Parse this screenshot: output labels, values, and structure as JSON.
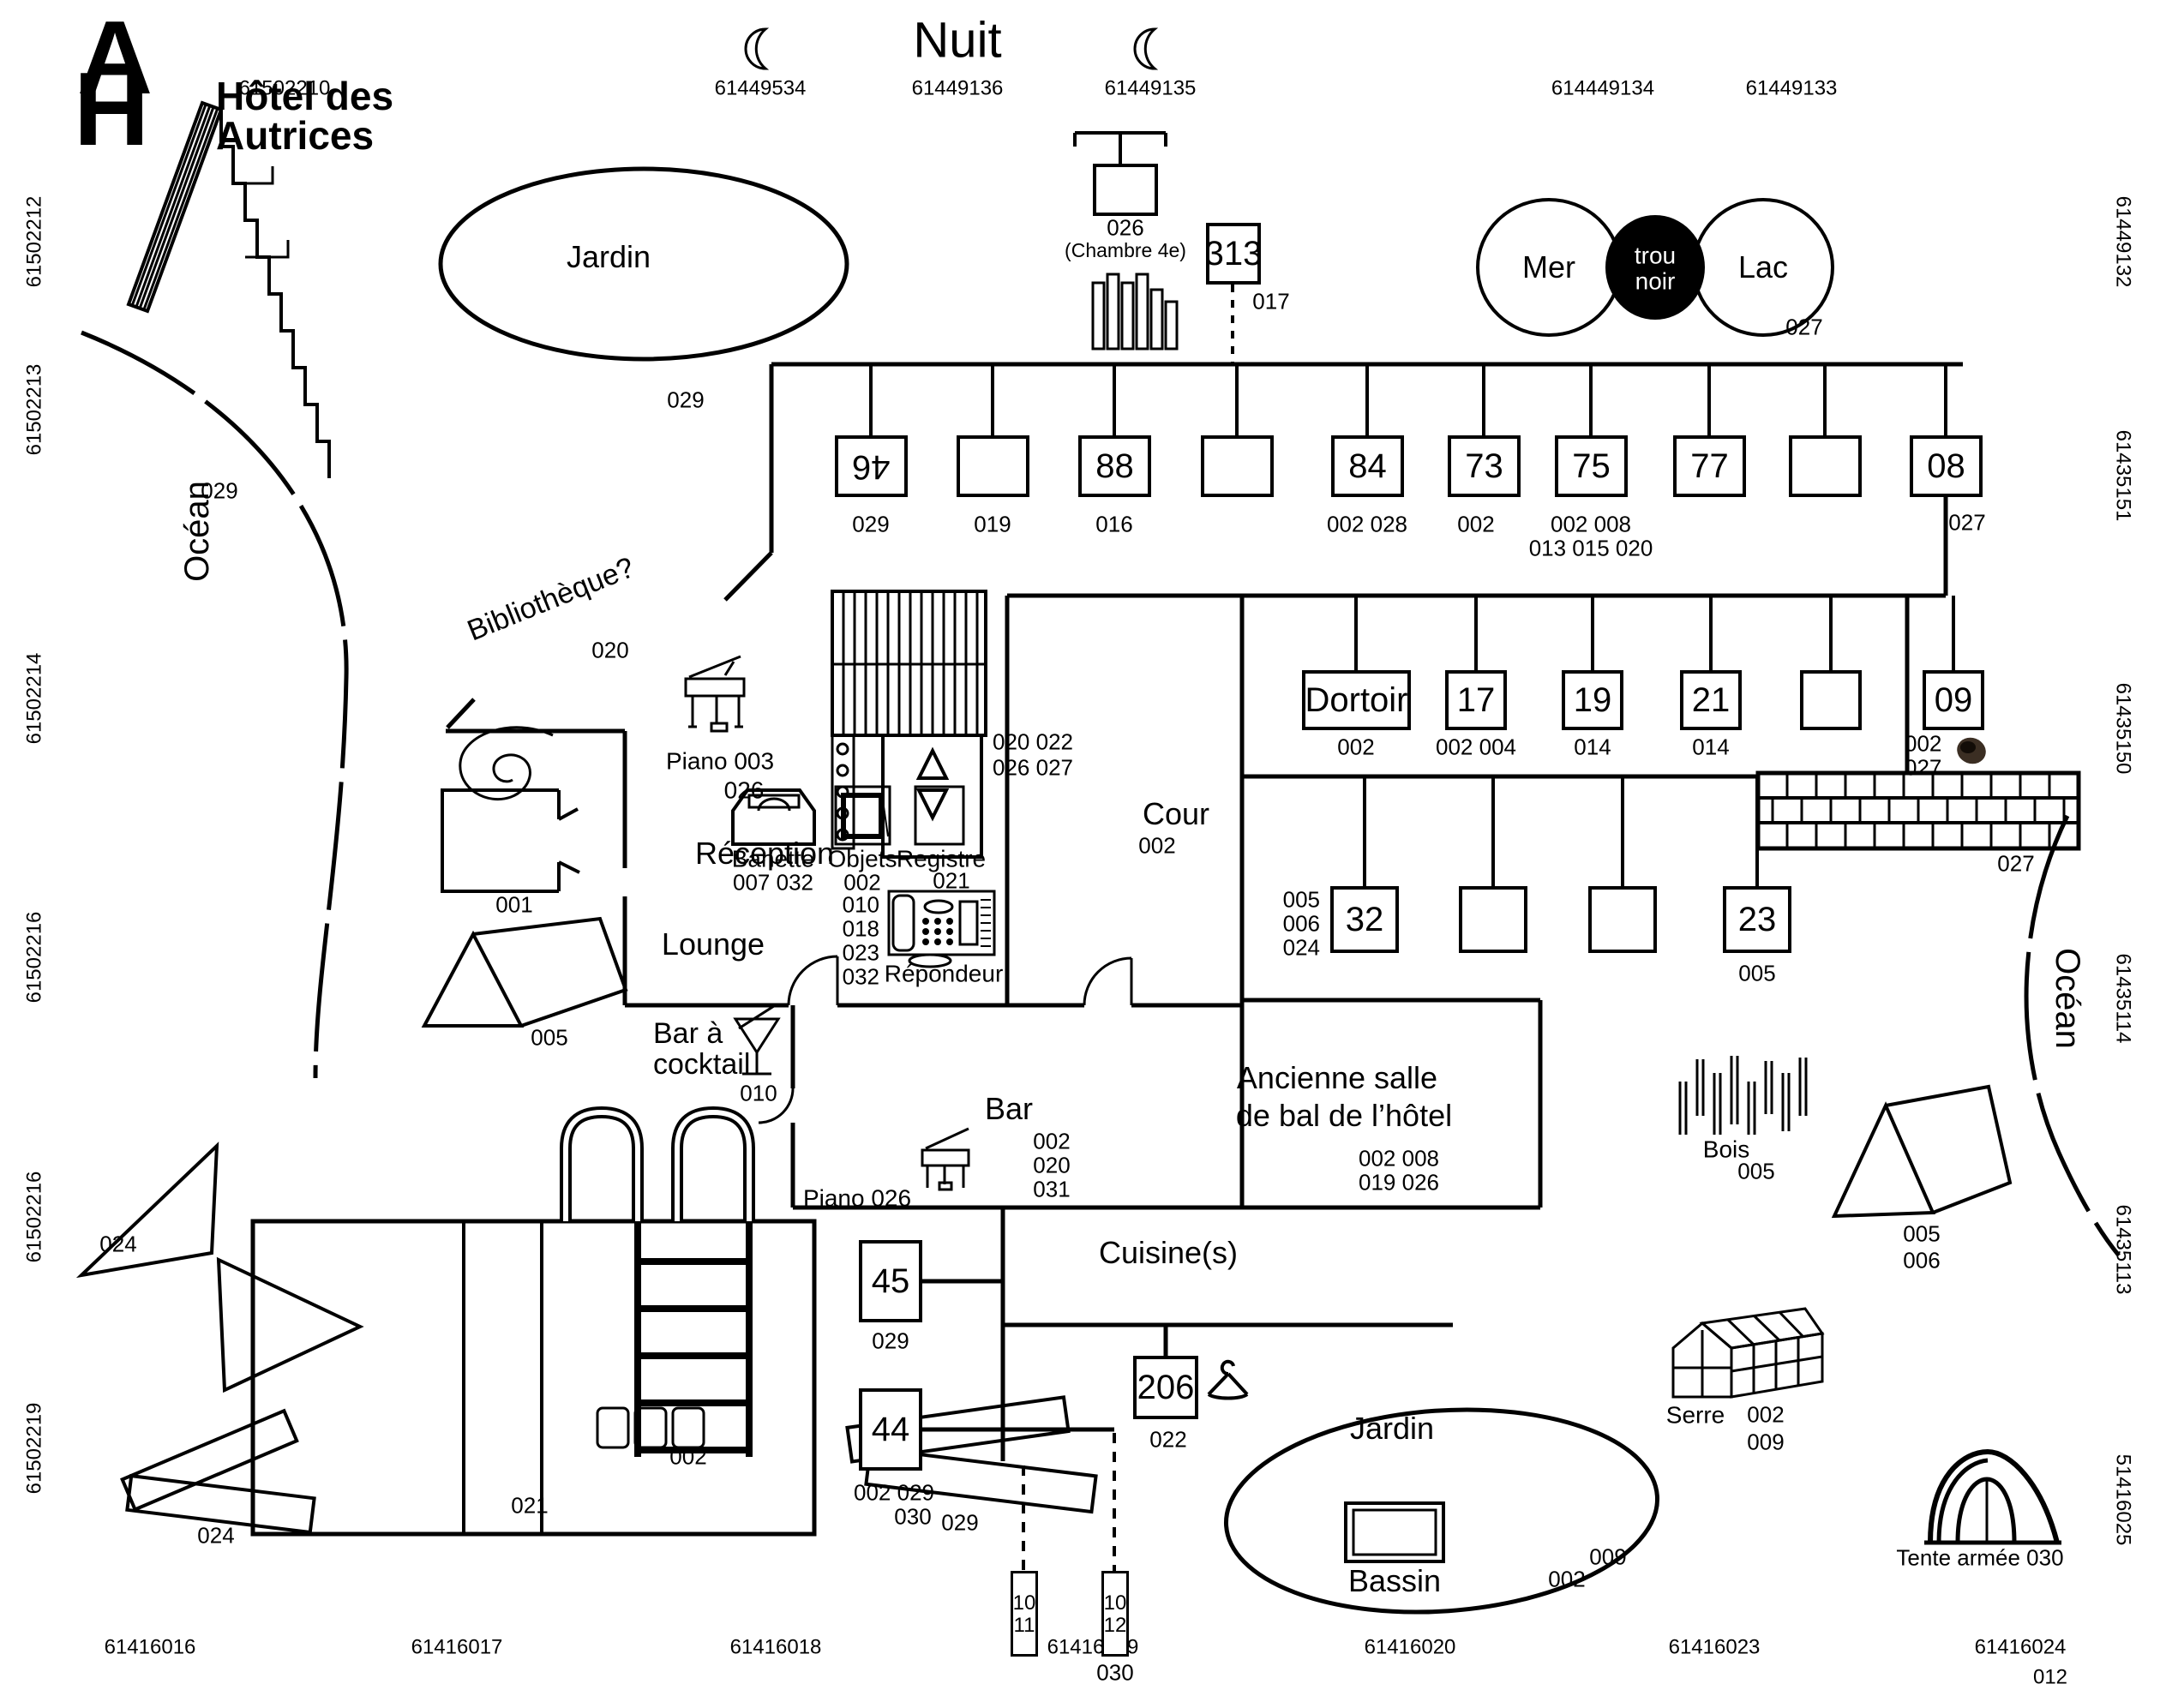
{
  "meta": {
    "logo_a": "A",
    "logo_h": "H",
    "title_line1": "Hôtel des",
    "title_line2": "Autrices",
    "heading": "Nuit",
    "ink_color": "#000000",
    "paper_color": "#ffffff",
    "smudge_color": "#2a1c10"
  },
  "edge_labels": {
    "top": [
      "61502210",
      "61449534",
      "61449136",
      "61449135",
      "614449134",
      "61449133"
    ],
    "left": [
      "61502212",
      "61502213",
      "61502214",
      "61502216",
      "61502216",
      "61502219"
    ],
    "right": [
      "61449132",
      "61435151",
      "61435150",
      "61435114",
      "61435113",
      "51416025"
    ],
    "bottom": [
      "61416016",
      "61416017",
      "61416018",
      "61416019",
      "61416020",
      "61416023",
      "61416024"
    ],
    "bottom_extra": "012"
  },
  "top_features": {
    "chambre4e": {
      "num": "026",
      "sub": "(Chambre 4e)"
    },
    "box313": {
      "num": "313",
      "note": "017"
    }
  },
  "row1": [
    {
      "num": "46",
      "note": "029"
    },
    {
      "num": "",
      "note": "019"
    },
    {
      "num": "88",
      "note": "016"
    },
    {
      "num": "",
      "note": ""
    },
    {
      "num": "84",
      "note": "002 028"
    },
    {
      "num": "73",
      "note": "002"
    },
    {
      "num": "75",
      "note": "002 008",
      "note2": "013 015 020"
    },
    {
      "num": "77",
      "note": ""
    },
    {
      "num": "",
      "note": ""
    },
    {
      "num": "08",
      "note": "027"
    }
  ],
  "row2": [
    {
      "num": "Dortoir",
      "note": "002"
    },
    {
      "num": "17",
      "note": "002 004"
    },
    {
      "num": "19",
      "note": "014"
    },
    {
      "num": "21",
      "note": "014"
    },
    {
      "num": "",
      "note": ""
    },
    {
      "num": "09",
      "note": "002",
      "note2": "027"
    }
  ],
  "row3": {
    "side_notes": [
      "005",
      "006",
      "024"
    ],
    "boxes": [
      {
        "num": "32",
        "note": ""
      },
      {
        "num": "",
        "note": ""
      },
      {
        "num": "",
        "note": ""
      },
      {
        "num": "23",
        "note": "005"
      }
    ]
  },
  "areas": {
    "jardin_top": {
      "label": "Jardin",
      "note": "029"
    },
    "mer": {
      "label": "Mer"
    },
    "trou_noir": {
      "line1": "trou",
      "line2": "noir"
    },
    "lac": {
      "label": "Lac",
      "note": "027"
    },
    "bibliotheque": {
      "label": "Bibliothèque?",
      "note": "020"
    },
    "reception": {
      "label": "Réception"
    },
    "lounge": {
      "label": "Lounge"
    },
    "cour": {
      "label": "Cour",
      "note": "002"
    },
    "bar": {
      "label": "Bar",
      "notes": [
        "002",
        "020",
        "031"
      ]
    },
    "bar_cocktail": {
      "line1": "Bar à",
      "line2": "cocktail",
      "note": "010"
    },
    "salle": {
      "line1": "Ancienne salle",
      "line2": "de bal de l’hôtel",
      "note1": "002 008",
      "note2": "019 026"
    },
    "cuisine": {
      "label": "Cuisine(s)"
    },
    "ocean_left": {
      "label": "Océan"
    },
    "ocean_right": {
      "label": "Océan"
    },
    "jardin_bottom": {
      "label": "Jardin",
      "bassin": "Bassin",
      "note1": "009",
      "note2": "002"
    }
  },
  "features": {
    "structure_tl": {
      "note": "029"
    },
    "box001": {
      "note": "001"
    },
    "piano_reception": {
      "label": "Piano 003",
      "note": "026"
    },
    "piano_bar": {
      "label": "Piano 026"
    },
    "banette": {
      "label": "Banette",
      "note": "007 032"
    },
    "objets": {
      "label": "Objets",
      "note": "002"
    },
    "registre": {
      "label": "Registre",
      "note": "021"
    },
    "repondeur": {
      "label": "Répondeur",
      "notes": [
        "010",
        "018",
        "023",
        "032"
      ]
    },
    "ascenseur": {
      "note1": "020 022",
      "note2": "026 027"
    },
    "brick_wall": {
      "note": "027"
    },
    "box45": {
      "num": "45",
      "note": "029"
    },
    "box44": {
      "num": "44",
      "note1": "002 029",
      "note2": "030"
    },
    "box206": {
      "num": "206",
      "note": "022"
    },
    "post1011": {
      "num": "1011"
    },
    "post1012": {
      "num": "1012",
      "note": "030"
    },
    "bois": {
      "label": "Bois",
      "note": "005"
    },
    "serre": {
      "label": "Serre",
      "note1": "002",
      "note2": "009"
    },
    "tent_left": {
      "note": "005"
    },
    "tent_right": {
      "note1": "005",
      "note2": "006"
    },
    "tente_armee": {
      "label": "Tente armée 030"
    },
    "pool": {
      "note": "021",
      "squares_note": "002"
    },
    "planks_left": {
      "note": "024"
    },
    "planks_right": {
      "note": "029"
    },
    "triangles": {
      "note": "024"
    }
  }
}
